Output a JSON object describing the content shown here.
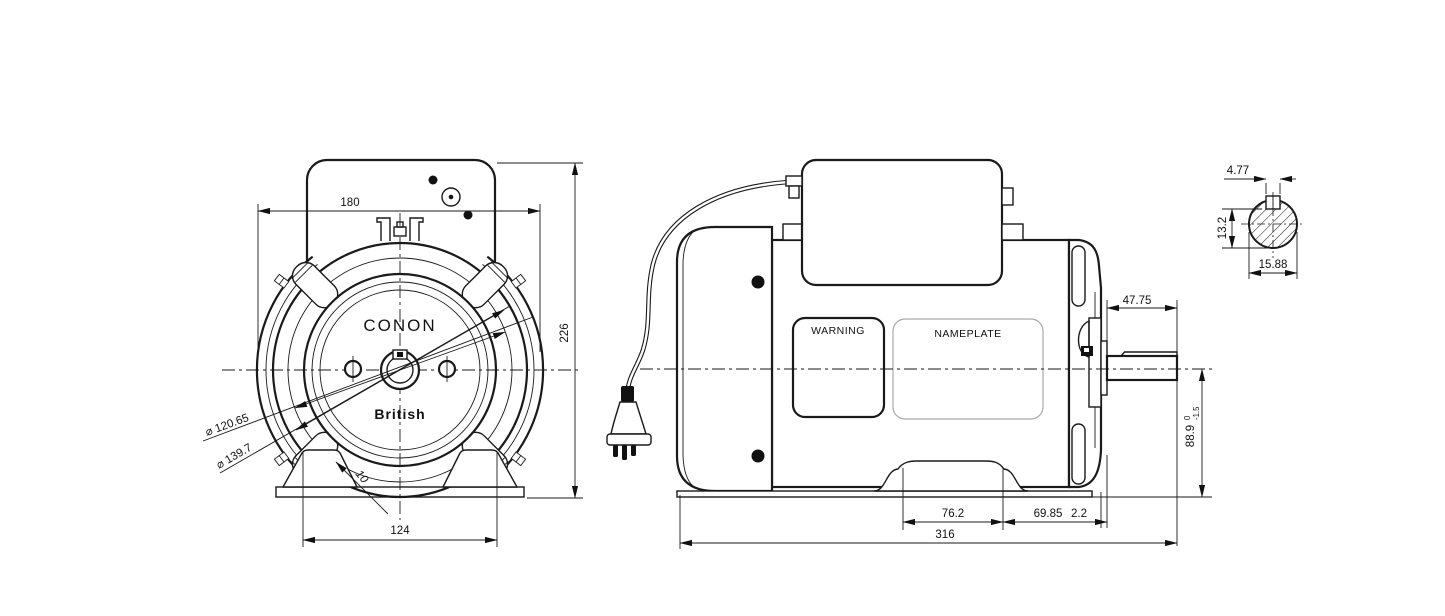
{
  "drawing": {
    "brand": "CONON",
    "sub_brand": "British",
    "front_view": {
      "dim_top_width": "180",
      "dim_overall_height": "226",
      "dim_foot_spacing": "124",
      "dia_bolt_circle": "⌀ 120.65",
      "dia_spigot": "⌀ 139.7",
      "dim_clamp_lug": "10"
    },
    "side_view": {
      "warning_label": "WARNING",
      "nameplate_label": "NAMEPLATE",
      "dim_shaft_extension": "47.75",
      "dim_shaft_height": "88.9",
      "dim_shaft_height_tol_upper": "0",
      "dim_shaft_height_tol_lower": "-1.5",
      "dim_foot_hole_spacing": "76.2",
      "dim_foot_to_face": "69.85",
      "dim_slinger": "2.2",
      "dim_overall_length": "316"
    },
    "shaft_section": {
      "dim_key_width": "4.77",
      "dim_flat_height": "13.2",
      "dim_shaft_diameter": "15.88"
    },
    "colors": {
      "line": "#1a1a1a",
      "background": "#ffffff",
      "nameplate_border": "#aaaaaa"
    }
  }
}
